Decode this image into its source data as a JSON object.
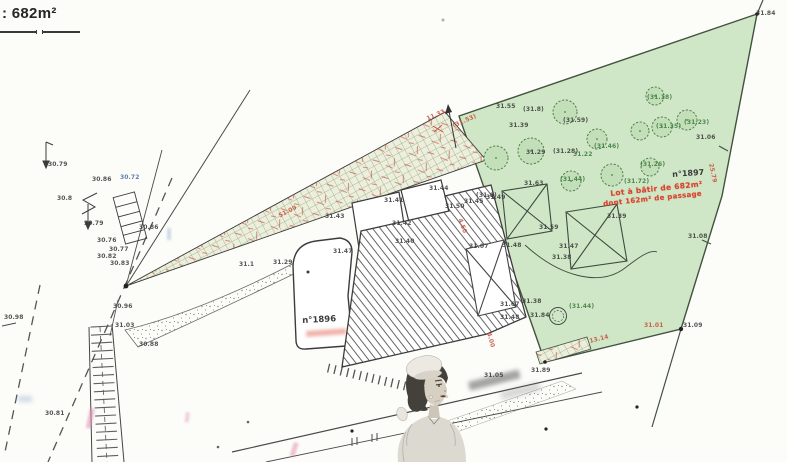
{
  "legend": {
    "area": ": 682m²"
  },
  "lot1897": {
    "number": "n°1897",
    "note1": "Lot à bâtir de 682m²",
    "note2": "dont 162m² de passage"
  },
  "lot1896": {
    "number": "n°1896"
  },
  "colors": {
    "ink": "#3c3c3c",
    "red": "#c8503c",
    "green": "#3f7a3f",
    "blue": "#4a6fa5",
    "note_red": "#d9442e",
    "parcel_fill": "#cfe7c6",
    "hatch_green": "#8fae7c"
  },
  "elevation_labels": [
    {
      "t": "30.79",
      "x": 48,
      "y": 162
    },
    {
      "t": "30.8",
      "x": 57,
      "y": 196
    },
    {
      "t": "30.79",
      "x": 84,
      "y": 221
    },
    {
      "t": "30.86",
      "x": 92,
      "y": 177
    },
    {
      "t": "30.72",
      "x": 120,
      "y": 175,
      "c": "blue"
    },
    {
      "t": "30.86",
      "x": 139,
      "y": 225
    },
    {
      "t": "30.76",
      "x": 97,
      "y": 238
    },
    {
      "t": "30.77",
      "x": 109,
      "y": 247
    },
    {
      "t": "30.82",
      "x": 97,
      "y": 254
    },
    {
      "t": "30.83",
      "x": 110,
      "y": 261
    },
    {
      "t": "30.98",
      "x": 4,
      "y": 315
    },
    {
      "t": "30.96",
      "x": 113,
      "y": 304
    },
    {
      "t": "31.03",
      "x": 115,
      "y": 323
    },
    {
      "t": "30.88",
      "x": 139,
      "y": 342
    },
    {
      "t": "30.81",
      "x": 45,
      "y": 411
    },
    {
      "t": "31.1",
      "x": 239,
      "y": 262
    },
    {
      "t": "31.29",
      "x": 273,
      "y": 260
    },
    {
      "t": "51.09",
      "x": 278,
      "y": 214,
      "c": "red",
      "r": -27
    },
    {
      "t": "11.33",
      "x": 426,
      "y": 117,
      "c": "red",
      "r": -24
    },
    {
      "t": "(31.53)",
      "x": 452,
      "y": 124,
      "c": "red",
      "r": -24
    },
    {
      "t": "31.55",
      "x": 496,
      "y": 104
    },
    {
      "t": "(31.8)",
      "x": 523,
      "y": 107
    },
    {
      "t": "31.39",
      "x": 509,
      "y": 123
    },
    {
      "t": "(31.59)",
      "x": 563,
      "y": 118
    },
    {
      "t": "31.29",
      "x": 526,
      "y": 150
    },
    {
      "t": "(31.28)",
      "x": 553,
      "y": 149
    },
    {
      "t": "(31.8)",
      "x": 476,
      "y": 193
    },
    {
      "t": "(31.44)",
      "x": 560,
      "y": 177,
      "c": "green"
    },
    {
      "t": "(31.72)",
      "x": 624,
      "y": 179,
      "c": "green"
    },
    {
      "t": "(31.26)",
      "x": 640,
      "y": 162,
      "c": "green"
    },
    {
      "t": "(31.46)",
      "x": 594,
      "y": 144,
      "c": "green"
    },
    {
      "t": "(31.35)",
      "x": 656,
      "y": 124,
      "c": "green"
    },
    {
      "t": "(31.23)",
      "x": 684,
      "y": 120,
      "c": "green"
    },
    {
      "t": "(31.18)",
      "x": 647,
      "y": 95,
      "c": "green"
    },
    {
      "t": "31.22",
      "x": 573,
      "y": 152,
      "c": "green"
    },
    {
      "t": "31.63",
      "x": 524,
      "y": 181
    },
    {
      "t": "31.59",
      "x": 539,
      "y": 225
    },
    {
      "t": "31.48",
      "x": 502,
      "y": 243
    },
    {
      "t": "31.39",
      "x": 607,
      "y": 214
    },
    {
      "t": "31.47",
      "x": 559,
      "y": 244
    },
    {
      "t": "31.38",
      "x": 552,
      "y": 255
    },
    {
      "t": "31.84",
      "x": 756,
      "y": 11
    },
    {
      "t": "31.06",
      "x": 696,
      "y": 135
    },
    {
      "t": "31.08",
      "x": 688,
      "y": 234
    },
    {
      "t": "25.79",
      "x": 713,
      "y": 163,
      "c": "red",
      "r": 78
    },
    {
      "t": "31.01",
      "x": 644,
      "y": 323,
      "c": "red"
    },
    {
      "t": "31.09",
      "x": 683,
      "y": 323
    },
    {
      "t": "13.14",
      "x": 589,
      "y": 339,
      "c": "red",
      "r": -14
    },
    {
      "t": "31.67",
      "x": 500,
      "y": 302
    },
    {
      "t": "31.38",
      "x": 522,
      "y": 299
    },
    {
      "t": "31.48",
      "x": 500,
      "y": 315
    },
    {
      "t": "31.84",
      "x": 530,
      "y": 313
    },
    {
      "t": "(31.44)",
      "x": 569,
      "y": 304,
      "c": "green"
    },
    {
      "t": "4.00",
      "x": 491,
      "y": 332,
      "c": "red",
      "r": 75
    },
    {
      "t": "31.89",
      "x": 531,
      "y": 368
    },
    {
      "t": "31.05",
      "x": 484,
      "y": 373
    },
    {
      "t": "31.41",
      "x": 384,
      "y": 198
    },
    {
      "t": "31.44",
      "x": 429,
      "y": 186
    },
    {
      "t": "31.43",
      "x": 325,
      "y": 214
    },
    {
      "t": "31.42",
      "x": 392,
      "y": 221
    },
    {
      "t": "31.40",
      "x": 395,
      "y": 239
    },
    {
      "t": "31.50",
      "x": 445,
      "y": 204
    },
    {
      "t": "31.45",
      "x": 464,
      "y": 199
    },
    {
      "t": "31.49",
      "x": 486,
      "y": 195
    },
    {
      "t": "31.47",
      "x": 333,
      "y": 249
    },
    {
      "t": "31.07",
      "x": 469,
      "y": 244
    },
    {
      "t": "4.50",
      "x": 462,
      "y": 218,
      "c": "red",
      "r": 70
    }
  ]
}
